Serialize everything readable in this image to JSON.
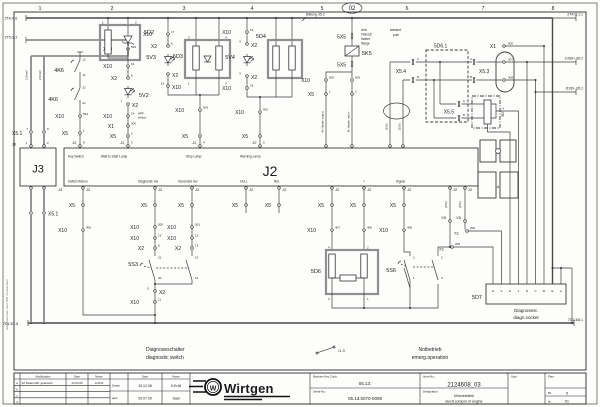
{
  "frame": {
    "columns": [
      "1",
      "2",
      "3",
      "4",
      "5",
      "6",
      "7",
      "8"
    ],
    "sheet_badge": "02",
    "side_note": "Schutzvermerk nach DIN 34 beachten"
  },
  "refs": {
    "top_left_1": "2T4:/4.6",
    "top_left_2": "2T5:/2.2",
    "top_right": "2T4:/8.1:1",
    "heater": "Bildung .05.2",
    "can_plus": "J1939+ /26.2",
    "can_minus": "J1939- /26.2",
    "bottom_left": "7D1:3/1.8",
    "bottom_right": "7D1:3/8.1",
    "emerg": "/1.3"
  },
  "conn": {
    "x10": "X10",
    "x2": "X2",
    "x1": "X1",
    "x5": "X5",
    "x5_1": "X5.1",
    "x5_3": "X5.3",
    "x5_4": "X5.4",
    "x5_5": "X5.5",
    "fx5": "5X5",
    "j2": "J2",
    "j3": "J3"
  },
  "components": {
    "d2": "5D2",
    "d3": "5D3",
    "d4": "5D4",
    "d6": "5D6",
    "d6_1": "5D6.1",
    "d7": "5D7",
    "d7_1": "5D7.1",
    "v2": "5V2",
    "v3": "5V3",
    "v4": "5V4",
    "k5": "5K5",
    "k6": "4K6",
    "s3": "5S3",
    "s6": "5S6"
  },
  "j2": {
    "label": "J2",
    "top": [
      "Key Switch",
      "Wait to Start Lamp",
      "Stop Lamp",
      "Warning Lamp"
    ],
    "bottom": [
      "Switch Return",
      "Diagnostic Sw",
      "Increment Sw",
      "Out.L",
      "Ret.",
      "-",
      "+",
      "Signal"
    ]
  },
  "j3": {
    "label": "J3"
  },
  "d7": {
    "letters": [
      "G",
      "F",
      "H",
      "J",
      "D",
      "C",
      "B",
      "E",
      "A"
    ]
  },
  "notes": {
    "heater_flange": [
      "Anti-",
      "Flansch",
      "heater",
      "flange"
    ],
    "twisted_pair": [
      "twisted",
      "pair"
    ],
    "air_out": "Air Heater output",
    "air_ret": "Air Heater return",
    "yellow": [
      "gelb",
      "yellow"
    ],
    "wire_gauge": "2,5mm²",
    "tp": "(150)",
    "diag_de": "Diagnoseschalter",
    "diag_en": "diagnostic switch",
    "emerg_de": "Notbetrieb",
    "emerg_en": "emerg.operation",
    "socket_de": "Diagnosest.",
    "socket_en": "diagn.socket",
    "view_letter": "A"
  },
  "pn": {
    "593": "593",
    "594": "594",
    "7": "7",
    "8": "8",
    "16": "16",
    "14": "14",
    "300": "300",
    "2": "2",
    "3": "3",
    "17": "17",
    "6": "6",
    "15": "15",
    "503": "503",
    "4": "4",
    "19": "19",
    "5": "5",
    "18": "18",
    "502": "502",
    "505": "505",
    "506": "506",
    "1": "1",
    "12": "12",
    "11": "11",
    "22": "22",
    "21": "21",
    "20": "20",
    "400": "400",
    "500": "500",
    "501": "501",
    "13": "13",
    "407": "407",
    "406": "406",
    "408": "408",
    "205": "205",
    "206": "206",
    "307": "307",
    "308": "308",
    "A": "A",
    "B": "B"
  },
  "title_block": {
    "mod_header": {
      "modification": "Modification",
      "date": "Date",
      "name": "Name"
    },
    "rows": [
      {
        "id": "a",
        "modification": "S2 Relais Abfr. getauscht",
        "date": "23.03.09",
        "name": "H.Kröll"
      },
      {
        "id": "b"
      },
      {
        "id": "c"
      },
      {
        "id": "d"
      }
    ],
    "drawn_label": "Drawn",
    "appr_label": "appr.",
    "drawn_date": "15.12.08",
    "drawn_name": "K.Kröll",
    "appr_date": "09.07.09",
    "appr_name": "Saal",
    "brand": "Wirtgen",
    "brand_letter": "W",
    "machine_key_label": "Machine Key Code:",
    "machine_key": "05.13.",
    "serial_label": "Serial-No.:",
    "serial": "05.13.0070-0095",
    "ident_label": "Ident-No.:",
    "ident": "2124608_03",
    "designation_label": "Designation:",
    "designation_de": "Motorelektrik",
    "designation_en": "electr.compon.of engine",
    "spot_label": "Spot:",
    "plan_label": "Plan:",
    "sheet_label": "Bl.",
    "sheet": "5",
    "of_label": "sh.",
    "of": "51"
  }
}
